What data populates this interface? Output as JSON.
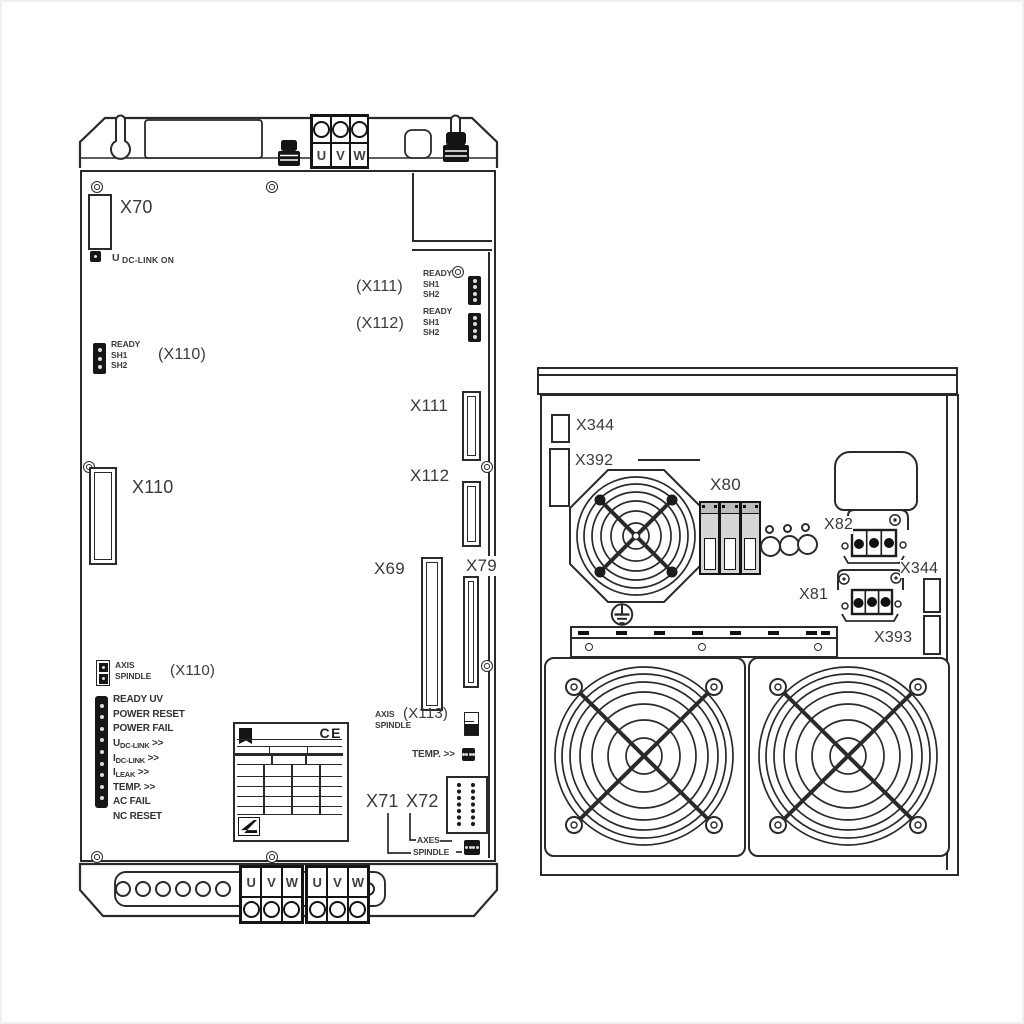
{
  "diagram": {
    "line_color": "#2a2a2a",
    "text_color": "#3a3a3a",
    "background": "#ffffff"
  },
  "left_device": {
    "top_terminals": [
      "U",
      "V",
      "W"
    ],
    "x70_label": "X70",
    "dc_link_led": {
      "prefix": "U",
      "label": "DC-LINK ON"
    },
    "x111_row": {
      "ref": "(X111)",
      "lines": [
        "READY",
        "SH1",
        "SH2"
      ]
    },
    "x112_row": {
      "ref": "(X112)",
      "lines": [
        "READY",
        "SH1",
        "SH2"
      ]
    },
    "x110_row": {
      "ref": "(X110)",
      "lines": [
        "READY",
        "SH1",
        "SH2"
      ]
    },
    "x110_label": "X110",
    "x111_label": "X111",
    "x112_label": "X112",
    "x69_label": "X69",
    "x79_label": "X79",
    "axis_spindle_x110": {
      "line1": "AXIS",
      "line2": "SPINDLE",
      "ref": "(X110)"
    },
    "status_list": [
      {
        "pre": "READY UV",
        "sub": "",
        "post": ""
      },
      {
        "pre": "POWER RESET",
        "sub": "",
        "post": ""
      },
      {
        "pre": "POWER FAIL",
        "sub": "",
        "post": ""
      },
      {
        "pre": "U",
        "sub": "DC-LINK",
        "post": " >>"
      },
      {
        "pre": "I",
        "sub": "DC-LINK",
        "post": " >>"
      },
      {
        "pre": "I",
        "sub": "LEAK",
        "post": " >>"
      },
      {
        "pre": "TEMP. >>",
        "sub": "",
        "post": ""
      },
      {
        "pre": "AC FAIL",
        "sub": "",
        "post": ""
      },
      {
        "pre": "NC RESET",
        "sub": "",
        "post": ""
      }
    ],
    "nameplate_ce": "CE",
    "axis_spindle_x113": {
      "line1": "AXIS",
      "line2": "SPINDLE",
      "ref": "(X113)"
    },
    "temp_label": "TEMP. >>",
    "x71_label": "X71",
    "x72_label": "X72",
    "axes_label": "AXES",
    "spindle_label": "SPINDLE",
    "bottom_terminals": [
      "U",
      "V",
      "W",
      "U",
      "V",
      "W"
    ]
  },
  "right_device": {
    "x344_top_label": "X344",
    "x392_label": "X392",
    "x80_label": "X80",
    "x82_label": "X82",
    "x344_mid_label": "X344",
    "x81_label": "X81",
    "x393_label": "X393"
  }
}
